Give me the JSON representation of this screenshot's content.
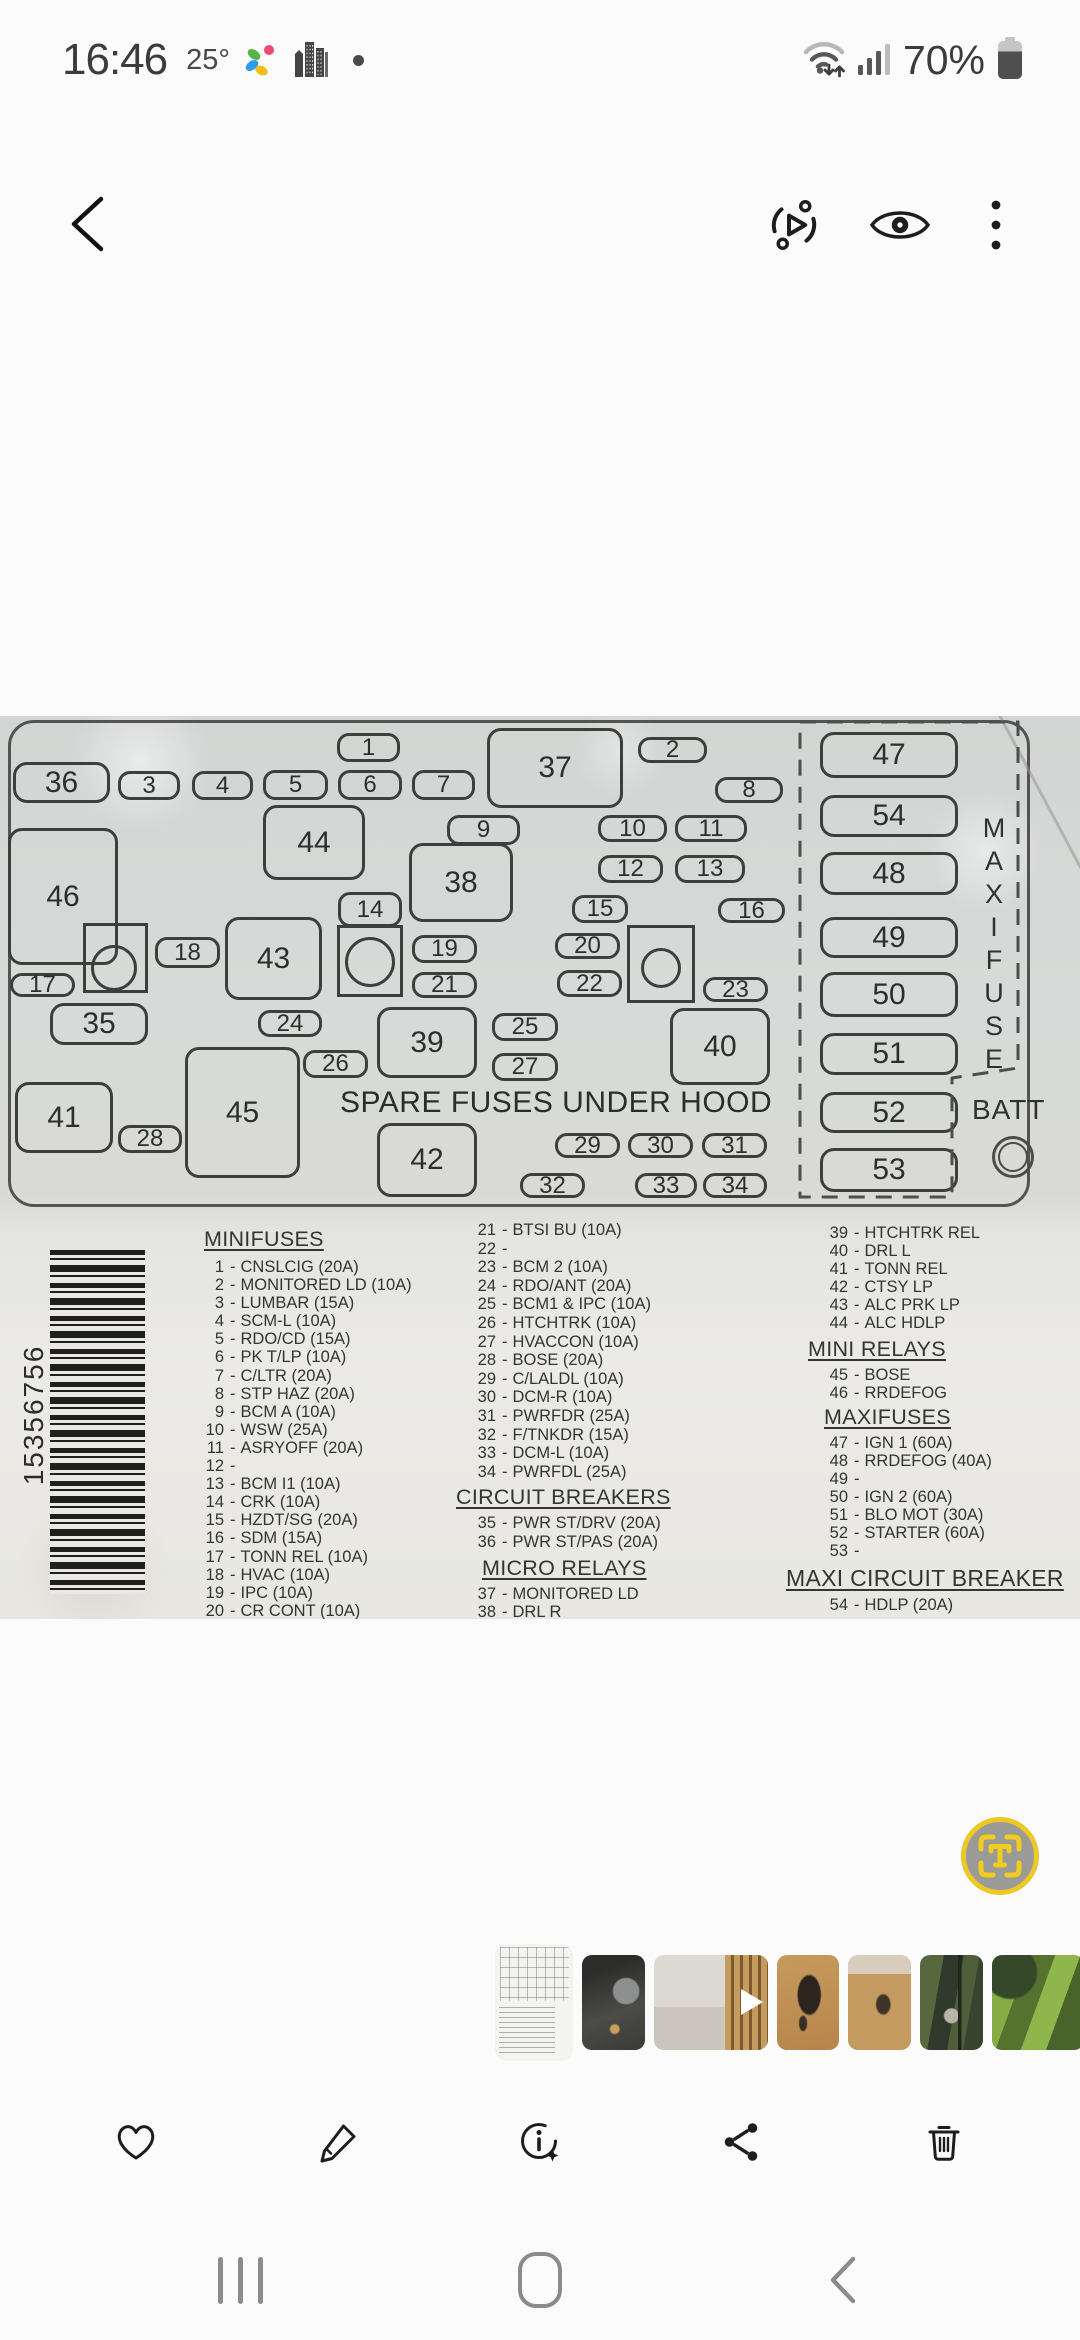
{
  "colors": {
    "accent_yellow": "#eec728",
    "toolbar_icon": "#1d1d1f",
    "nav_icon": "#8b8b8b",
    "label_ink": "#33362f"
  },
  "status_bar": {
    "time": "16:46",
    "temperature": "25°",
    "battery_percent": "70%",
    "icons": [
      "weather-app-icon",
      "city-buildings-icon",
      "notification-dot",
      "wifi-icon",
      "signal-icon",
      "battery-icon"
    ]
  },
  "top_toolbar": {
    "icons": [
      "back-icon",
      "motion-photo-icon",
      "eye-icon",
      "more-options-icon"
    ]
  },
  "photo": {
    "panel": {
      "spare_fuses_label": "SPARE FUSES UNDER HOOD",
      "maxifuse_label": "MAXIFUSE",
      "batt_label": "BATT",
      "boxes": [
        {
          "n": "1",
          "x": 337,
          "y": 17,
          "w": 63,
          "h": 29
        },
        {
          "n": "2",
          "x": 638,
          "y": 21,
          "w": 69,
          "h": 26
        },
        {
          "n": "36",
          "x": 13,
          "y": 46,
          "w": 97,
          "h": 41
        },
        {
          "n": "3",
          "x": 118,
          "y": 55,
          "w": 62,
          "h": 29
        },
        {
          "n": "4",
          "x": 192,
          "y": 55,
          "w": 61,
          "h": 29
        },
        {
          "n": "5",
          "x": 263,
          "y": 54,
          "w": 65,
          "h": 30
        },
        {
          "n": "6",
          "x": 338,
          "y": 54,
          "w": 64,
          "h": 30
        },
        {
          "n": "7",
          "x": 412,
          "y": 54,
          "w": 63,
          "h": 30
        },
        {
          "n": "37",
          "x": 487,
          "y": 12,
          "w": 136,
          "h": 80
        },
        {
          "n": "8",
          "x": 715,
          "y": 61,
          "w": 68,
          "h": 26
        },
        {
          "n": "44",
          "x": 263,
          "y": 89,
          "w": 102,
          "h": 75
        },
        {
          "n": "9",
          "x": 447,
          "y": 99,
          "w": 73,
          "h": 30
        },
        {
          "n": "10",
          "x": 598,
          "y": 99,
          "w": 69,
          "h": 27
        },
        {
          "n": "11",
          "x": 675,
          "y": 99,
          "w": 72,
          "h": 27
        },
        {
          "n": "46",
          "x": 8,
          "y": 112,
          "w": 110,
          "h": 137
        },
        {
          "n": "38",
          "x": 409,
          "y": 127,
          "w": 104,
          "h": 79
        },
        {
          "n": "12",
          "x": 598,
          "y": 139,
          "w": 65,
          "h": 28
        },
        {
          "n": "13",
          "x": 675,
          "y": 139,
          "w": 70,
          "h": 28
        },
        {
          "n": "14",
          "x": 338,
          "y": 176,
          "w": 64,
          "h": 35
        },
        {
          "n": "15",
          "x": 572,
          "y": 179,
          "w": 56,
          "h": 28
        },
        {
          "n": "16",
          "x": 718,
          "y": 182,
          "w": 67,
          "h": 25
        },
        {
          "n": "43",
          "x": 225,
          "y": 201,
          "w": 97,
          "h": 83
        },
        {
          "n": "18",
          "x": 155,
          "y": 221,
          "w": 65,
          "h": 31
        },
        {
          "n": "19",
          "x": 412,
          "y": 219,
          "w": 65,
          "h": 28
        },
        {
          "n": "20",
          "x": 555,
          "y": 217,
          "w": 65,
          "h": 26
        },
        {
          "n": "17",
          "x": 10,
          "y": 257,
          "w": 65,
          "h": 24
        },
        {
          "n": "21",
          "x": 412,
          "y": 256,
          "w": 65,
          "h": 26
        },
        {
          "n": "22",
          "x": 557,
          "y": 254,
          "w": 65,
          "h": 27
        },
        {
          "n": "23",
          "x": 703,
          "y": 261,
          "w": 65,
          "h": 25
        },
        {
          "n": "35",
          "x": 50,
          "y": 287,
          "w": 98,
          "h": 42
        },
        {
          "n": "24",
          "x": 258,
          "y": 294,
          "w": 64,
          "h": 27
        },
        {
          "n": "39",
          "x": 377,
          "y": 291,
          "w": 100,
          "h": 71
        },
        {
          "n": "25",
          "x": 492,
          "y": 297,
          "w": 66,
          "h": 28
        },
        {
          "n": "40",
          "x": 670,
          "y": 292,
          "w": 100,
          "h": 77
        },
        {
          "n": "26",
          "x": 303,
          "y": 334,
          "w": 65,
          "h": 28
        },
        {
          "n": "27",
          "x": 492,
          "y": 337,
          "w": 66,
          "h": 28
        },
        {
          "n": "41",
          "x": 15,
          "y": 366,
          "w": 98,
          "h": 71
        },
        {
          "n": "45",
          "x": 185,
          "y": 331,
          "w": 115,
          "h": 131
        },
        {
          "n": "28",
          "x": 118,
          "y": 409,
          "w": 64,
          "h": 28
        },
        {
          "n": "42",
          "x": 377,
          "y": 407,
          "w": 100,
          "h": 74
        },
        {
          "n": "29",
          "x": 555,
          "y": 417,
          "w": 65,
          "h": 25
        },
        {
          "n": "30",
          "x": 628,
          "y": 417,
          "w": 65,
          "h": 25
        },
        {
          "n": "31",
          "x": 702,
          "y": 417,
          "w": 65,
          "h": 25
        },
        {
          "n": "32",
          "x": 520,
          "y": 457,
          "w": 65,
          "h": 25
        },
        {
          "n": "33",
          "x": 635,
          "y": 457,
          "w": 62,
          "h": 25
        },
        {
          "n": "34",
          "x": 703,
          "y": 457,
          "w": 64,
          "h": 25
        },
        {
          "n": "47",
          "x": 820,
          "y": 16,
          "w": 138,
          "h": 46
        },
        {
          "n": "54",
          "x": 820,
          "y": 79,
          "w": 138,
          "h": 42
        },
        {
          "n": "48",
          "x": 820,
          "y": 136,
          "w": 138,
          "h": 43
        },
        {
          "n": "49",
          "x": 820,
          "y": 201,
          "w": 138,
          "h": 41
        },
        {
          "n": "50",
          "x": 820,
          "y": 256,
          "w": 138,
          "h": 45
        },
        {
          "n": "51",
          "x": 820,
          "y": 317,
          "w": 138,
          "h": 42
        },
        {
          "n": "52",
          "x": 820,
          "y": 376,
          "w": 138,
          "h": 41
        },
        {
          "n": "53",
          "x": 820,
          "y": 432,
          "w": 138,
          "h": 44
        }
      ],
      "relay_squares": [
        {
          "x": 83,
          "y": 207,
          "w": 65,
          "h": 70,
          "cx": 31,
          "cy": 45,
          "r": 23
        },
        {
          "x": 337,
          "y": 209,
          "w": 66,
          "h": 72,
          "cx": 33,
          "cy": 37,
          "r": 25
        },
        {
          "x": 627,
          "y": 209,
          "w": 68,
          "h": 78,
          "cx": 34,
          "cy": 43,
          "r": 20
        }
      ]
    },
    "barcode_number": "15356756",
    "fuse_lists": [
      {
        "name": "column-1",
        "entries": [
          {
            "h": "MINIFUSES"
          },
          {
            "n": "1",
            "t": "CNSLCIG (20A)"
          },
          {
            "n": "2",
            "t": "MONITORED LD (10A)"
          },
          {
            "n": "3",
            "t": "LUMBAR (15A)"
          },
          {
            "n": "4",
            "t": "SCM-L (10A)"
          },
          {
            "n": "5",
            "t": "RDO/CD (15A)"
          },
          {
            "n": "6",
            "t": "PK T/LP (10A)"
          },
          {
            "n": "7",
            "t": "C/LTR (20A)"
          },
          {
            "n": "8",
            "t": "STP HAZ (20A)"
          },
          {
            "n": "9",
            "t": "BCM A (10A)"
          },
          {
            "n": "10",
            "t": "WSW (25A)"
          },
          {
            "n": "11",
            "t": "ASRYOFF (20A)"
          },
          {
            "n": "12",
            "t": ""
          },
          {
            "n": "13",
            "t": "BCM I1 (10A)"
          },
          {
            "n": "14",
            "t": "CRK (10A)"
          },
          {
            "n": "15",
            "t": "HZDT/SG (20A)"
          },
          {
            "n": "16",
            "t": "SDM (15A)"
          },
          {
            "n": "17",
            "t": "TONN REL (10A)"
          },
          {
            "n": "18",
            "t": "HVAC (10A)"
          },
          {
            "n": "19",
            "t": "IPC (10A)"
          },
          {
            "n": "20",
            "t": "CR CONT (10A)"
          }
        ]
      },
      {
        "name": "column-2",
        "entries": [
          {
            "n": "21",
            "t": "BTSI BU (10A)"
          },
          {
            "n": "22",
            "t": ""
          },
          {
            "n": "23",
            "t": "BCM 2 (10A)"
          },
          {
            "n": "24",
            "t": "RDO/ANT (20A)"
          },
          {
            "n": "25",
            "t": "BCM1 & IPC (10A)"
          },
          {
            "n": "26",
            "t": "HTCHTRK (10A)"
          },
          {
            "n": "27",
            "t": "HVACCON (10A)"
          },
          {
            "n": "28",
            "t": "BOSE (20A)"
          },
          {
            "n": "29",
            "t": "C/LALDL (10A)"
          },
          {
            "n": "30",
            "t": "DCM-R (10A)"
          },
          {
            "n": "31",
            "t": "PWRFDR (25A)"
          },
          {
            "n": "32",
            "t": "F/TNKDR (15A)"
          },
          {
            "n": "33",
            "t": "DCM-L (10A)"
          },
          {
            "n": "34",
            "t": "PWRFDL (25A)"
          },
          {
            "h": "CIRCUIT BREAKERS"
          },
          {
            "n": "35",
            "t": "PWR ST/DRV (20A)"
          },
          {
            "n": "36",
            "t": "PWR ST/PAS (20A)"
          },
          {
            "h": "MICRO RELAYS"
          },
          {
            "n": "37",
            "t": "MONITORED LD"
          },
          {
            "n": "38",
            "t": "DRL R"
          }
        ]
      },
      {
        "name": "column-3",
        "entries": [
          {
            "n": "39",
            "t": "HTCHTRK REL"
          },
          {
            "n": "40",
            "t": "DRL L"
          },
          {
            "n": "41",
            "t": "TONN REL"
          },
          {
            "n": "42",
            "t": "CTSY LP"
          },
          {
            "n": "43",
            "t": "ALC PRK LP"
          },
          {
            "n": "44",
            "t": "ALC HDLP"
          },
          {
            "h": "MINI RELAYS"
          },
          {
            "n": "45",
            "t": "BOSE"
          },
          {
            "n": "46",
            "t": "RRDEFOG"
          },
          {
            "h": "MAXIFUSES"
          },
          {
            "n": "47",
            "t": "IGN 1 (60A)"
          },
          {
            "n": "48",
            "t": "RRDEFOG (40A)"
          },
          {
            "n": "49",
            "t": ""
          },
          {
            "n": "50",
            "t": "IGN 2 (60A)"
          },
          {
            "n": "51",
            "t": "BLO MOT (30A)"
          },
          {
            "n": "52",
            "t": "STARTER (60A)"
          },
          {
            "n": "53",
            "t": ""
          },
          {
            "h": "MAXI CIRCUIT BREAKER"
          },
          {
            "n": "54",
            "t": "HDLP (20A)"
          }
        ]
      }
    ]
  },
  "scan_button": {
    "letter": "T"
  },
  "thumbnails": [
    {
      "kind": "fuse-diagram",
      "w": 78,
      "selected": true
    },
    {
      "kind": "couch",
      "w": 63
    },
    {
      "kind": "hallway",
      "w": 114,
      "video": true
    },
    {
      "kind": "floor-debris",
      "w": 62
    },
    {
      "kind": "floor-debris-small",
      "w": 63
    },
    {
      "kind": "garden",
      "w": 63
    },
    {
      "kind": "bushes",
      "w": 92
    }
  ],
  "bottom_toolbar": {
    "icons": [
      "favorite-icon",
      "edit-icon",
      "details-icon",
      "share-icon",
      "delete-icon"
    ]
  },
  "nav_bar": {
    "icons": [
      "recents-icon",
      "home-icon",
      "back-icon"
    ]
  }
}
